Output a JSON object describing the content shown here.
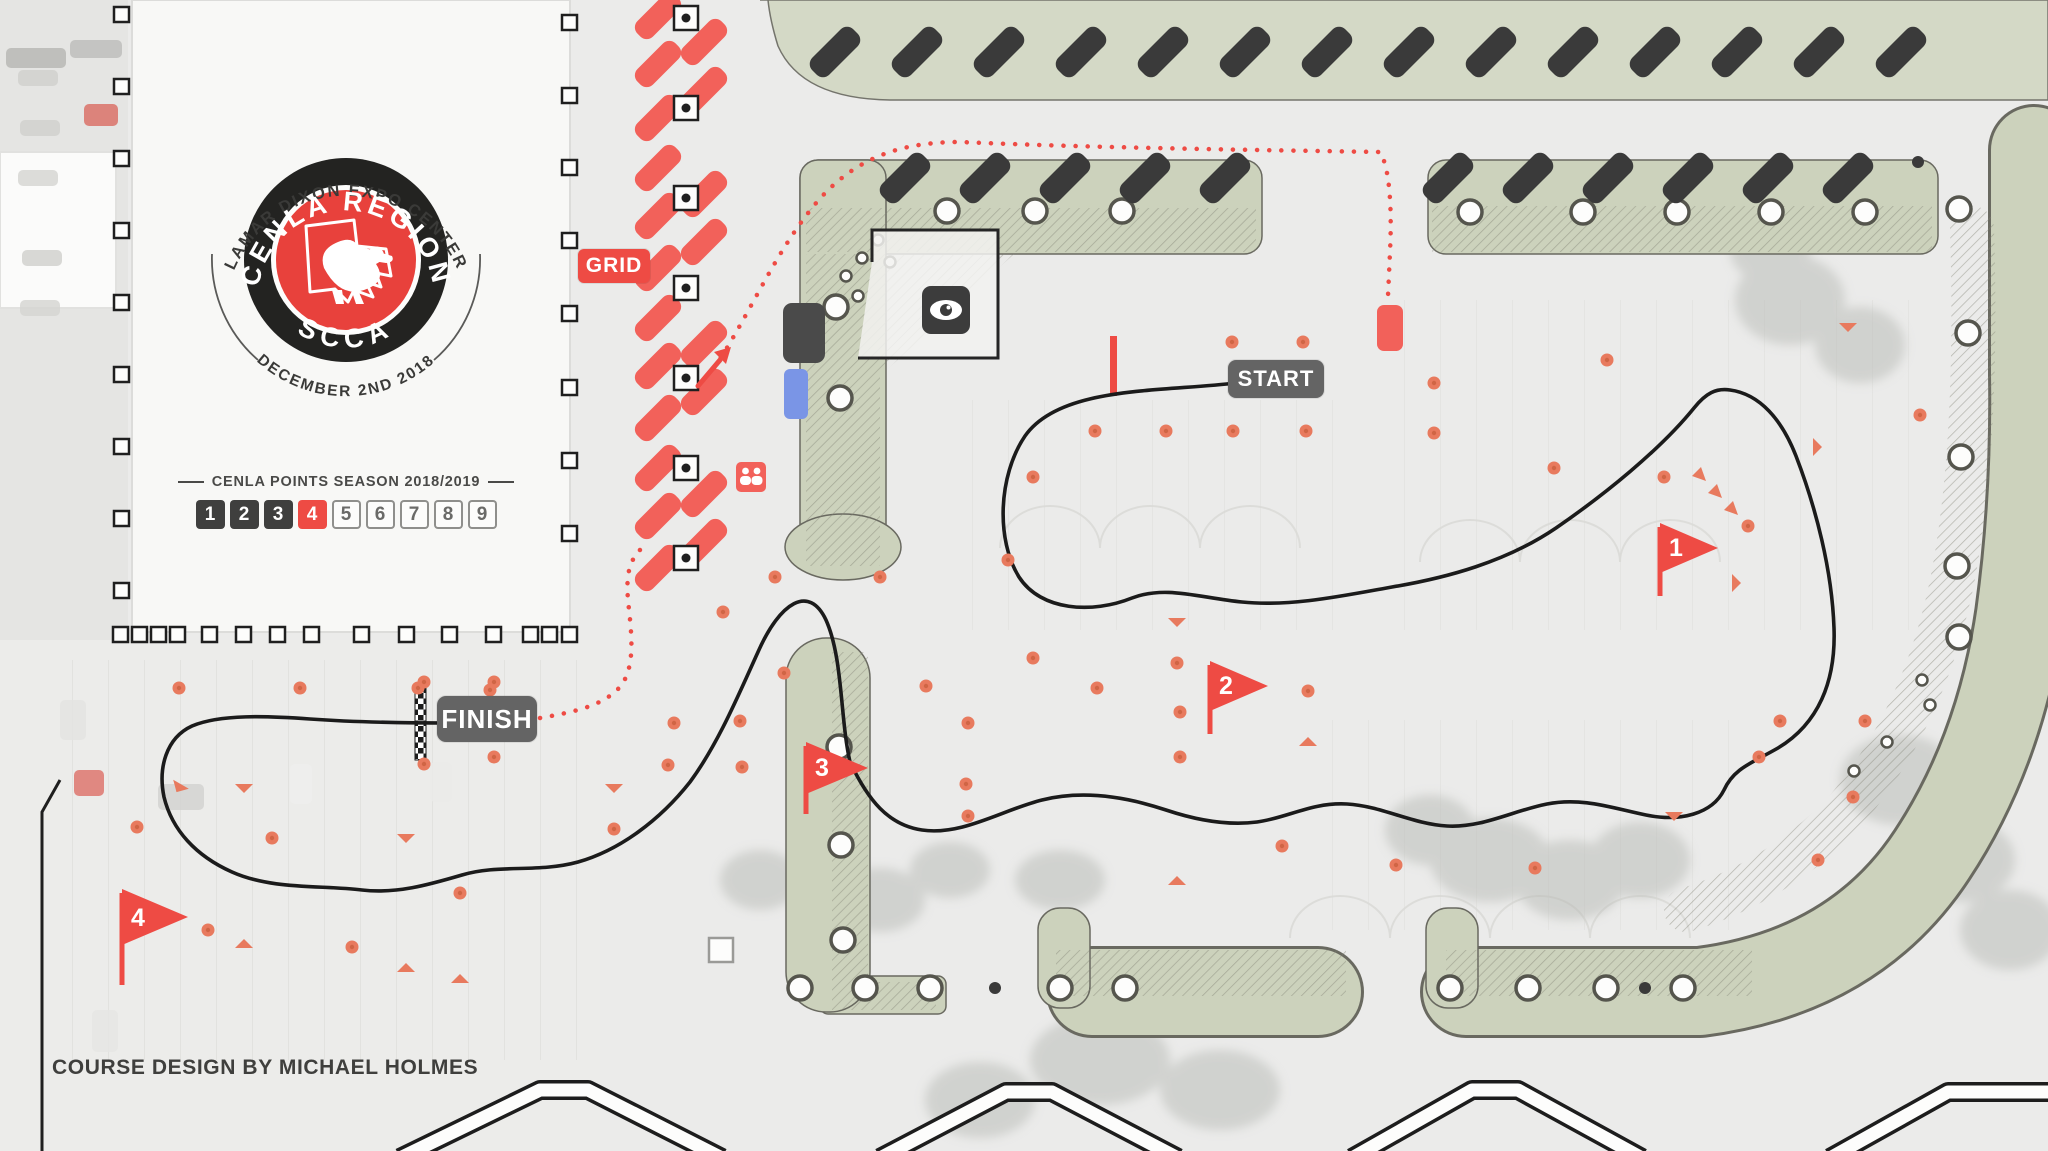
{
  "logo": {
    "arc_top": "LAMAR DIXON EXPO CENTER",
    "ring_top": "CENLA REGION",
    "ring_bottom": "SCCA",
    "arc_bottom": "DECEMBER 2ND 2018"
  },
  "points": {
    "heading": "CENLA POINTS SEASON 2018/2019",
    "boxes": [
      "1",
      "2",
      "3",
      "4",
      "5",
      "6",
      "7",
      "8",
      "9"
    ],
    "active": "4"
  },
  "badges": {
    "grid": "GRID",
    "start": "START",
    "finish": "FINISH"
  },
  "flags": [
    {
      "label": "1"
    },
    {
      "label": "2"
    },
    {
      "label": "3"
    },
    {
      "label": "4"
    }
  ],
  "credit": "COURSE DESIGN BY MICHAEL HOLMES",
  "colors": {
    "accent_red": "#ee4b44",
    "salmon": "#f2615a",
    "cone_orange": "#e87a5e",
    "sage_green": "#ccd2bc",
    "sage_light": "#d4d9c6",
    "badge_gray": "#646464",
    "dark_gray": "#3c3c3c",
    "course_black": "#1b1b1b"
  }
}
